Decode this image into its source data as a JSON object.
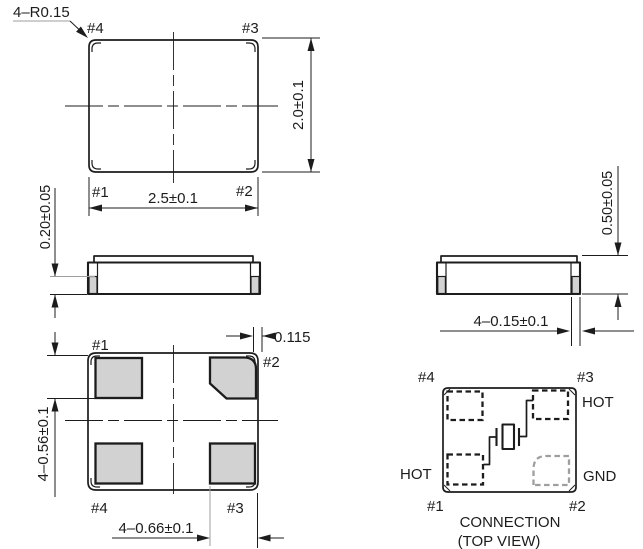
{
  "colors": {
    "line": "#1c1c1c",
    "pad_fill": "#d2d2d2",
    "gray_line": "#9e9e9e",
    "background": "#ffffff"
  },
  "top_view": {
    "corner_radius_note": "4–R0.15",
    "pin_top_left": "#4",
    "pin_top_right": "#3",
    "pin_bottom_left": "#1",
    "pin_bottom_right": "#2",
    "width_dim": "2.5±0.1",
    "height_dim": "2.0±0.1"
  },
  "side_view_front": {
    "electrode_height_dim": "0.20±0.05"
  },
  "side_view_side": {
    "height_dim": "0.50±0.05",
    "electrode_width_dim": "4–0.15±0.1"
  },
  "bottom_view": {
    "pin_top_left": "#1",
    "pin_top_right": "#2",
    "pin_bottom_left": "#4",
    "pin_bottom_right": "#3",
    "corner_offset_dim": "0.115",
    "pad_height_dim": "4–0.56±0.1",
    "pad_width_dim": "4–0.66±0.1"
  },
  "connection_view": {
    "pin_top_left": "#4",
    "pin_top_right": "#3",
    "pin_bottom_left": "#1",
    "pin_bottom_right": "#2",
    "label_pin3": "HOT",
    "label_pin1": "HOT",
    "label_pin2": "GND",
    "caption_line1": "CONNECTION",
    "caption_line2": "(TOP VIEW)"
  }
}
